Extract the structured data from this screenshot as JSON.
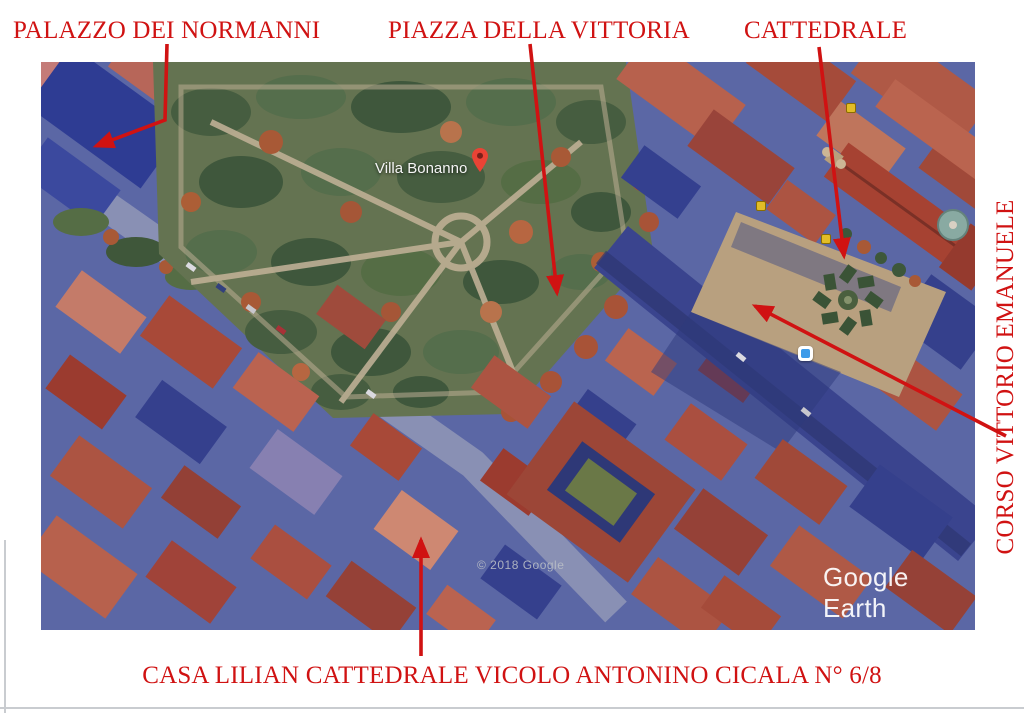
{
  "page": {
    "background": "#ffffff"
  },
  "colors": {
    "annotation_red": "#d01212",
    "pin_red": "#ea4335",
    "camera_blue": "#3d9be9",
    "poi_yellow": "#e2bd27"
  },
  "annotations": {
    "palazzo_dei_normanni": "PALAZZO DEI NORMANNI",
    "piazza_della_vittoria": "PIAZZA DELLA VITTORIA",
    "cattedrale": "CATTEDRALE",
    "corso_vittorio_emanuele": "CORSO VITTORIO EMANUELE",
    "casa_lilian": "CASA LILIAN CATTEDRALE VICOLO ANTONINO CICALA N° 6/8"
  },
  "map": {
    "place_label": "Villa Bonanno",
    "copyright_watermark": "© 2018 Google",
    "watermark_logo": "Google Earth"
  }
}
